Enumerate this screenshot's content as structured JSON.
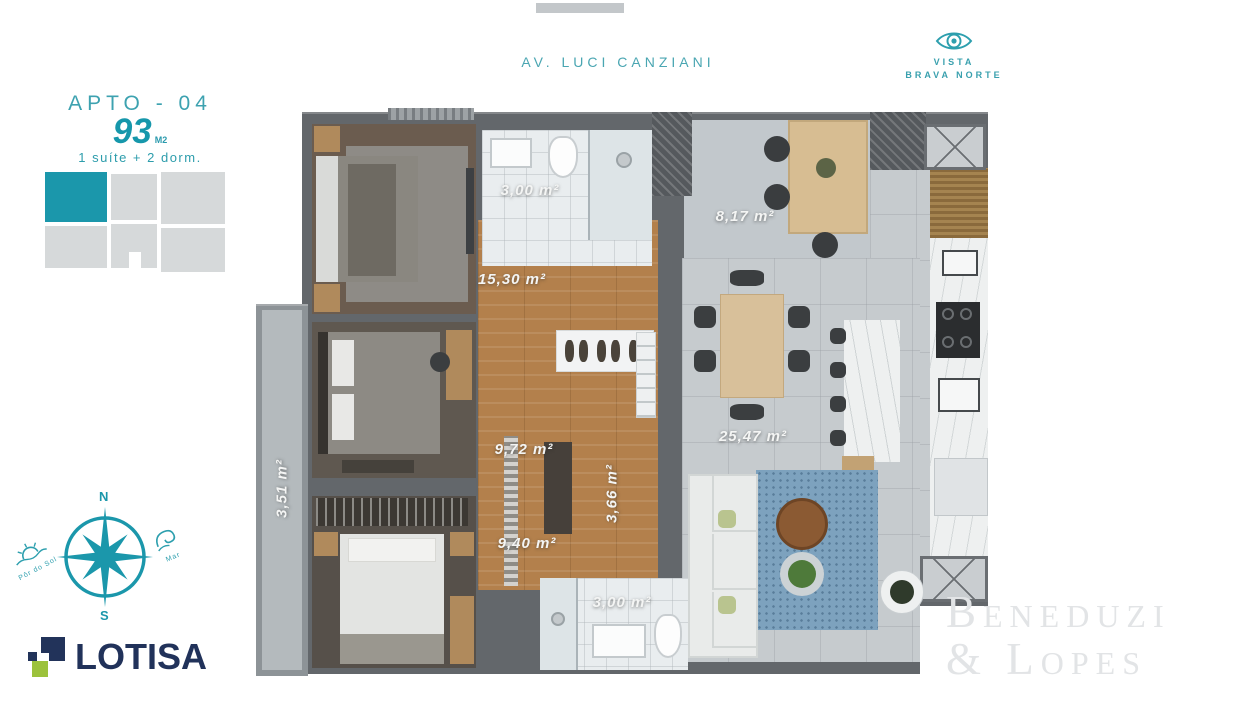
{
  "top": {
    "street_label": "AV. LUCI CANZIANI",
    "vista_line1": "VISTA",
    "vista_line2": "BRAVA NORTE"
  },
  "apto": {
    "title": "APTO - 04",
    "area_number": "93",
    "area_unit": "M2",
    "subtitle": "1 suíte + 2 dorm."
  },
  "compass": {
    "north": "N",
    "south": "S",
    "sunset": "Pôr do Sol",
    "sea": "Mar"
  },
  "logo_text": "LOTISA",
  "watermark": {
    "line1": "Beneduzi",
    "line2": "& Lopes"
  },
  "floorplan": {
    "labels": [
      {
        "id": "bath-top",
        "text": "3,00 m²"
      },
      {
        "id": "terrace",
        "text": "8,17 m²"
      },
      {
        "id": "hall-top",
        "text": "15,30 m²"
      },
      {
        "id": "hall-mid",
        "text": "9,72 m²"
      },
      {
        "id": "hall-small",
        "text": "3,66 m²"
      },
      {
        "id": "hall-bottom",
        "text": "9,40 m²"
      },
      {
        "id": "living",
        "text": "25,47 m²"
      },
      {
        "id": "balcony",
        "text": "3,51 m²"
      },
      {
        "id": "bath-bottom",
        "text": "3,00 m²"
      }
    ]
  },
  "colors": {
    "teal": "#1b97ab",
    "navy": "#22335a",
    "green": "#9cc23c",
    "wall_gray": "#63676b",
    "wood": "#b3804c",
    "tile_gray": "#c6cbce",
    "rug_blue": "#7da2be"
  }
}
